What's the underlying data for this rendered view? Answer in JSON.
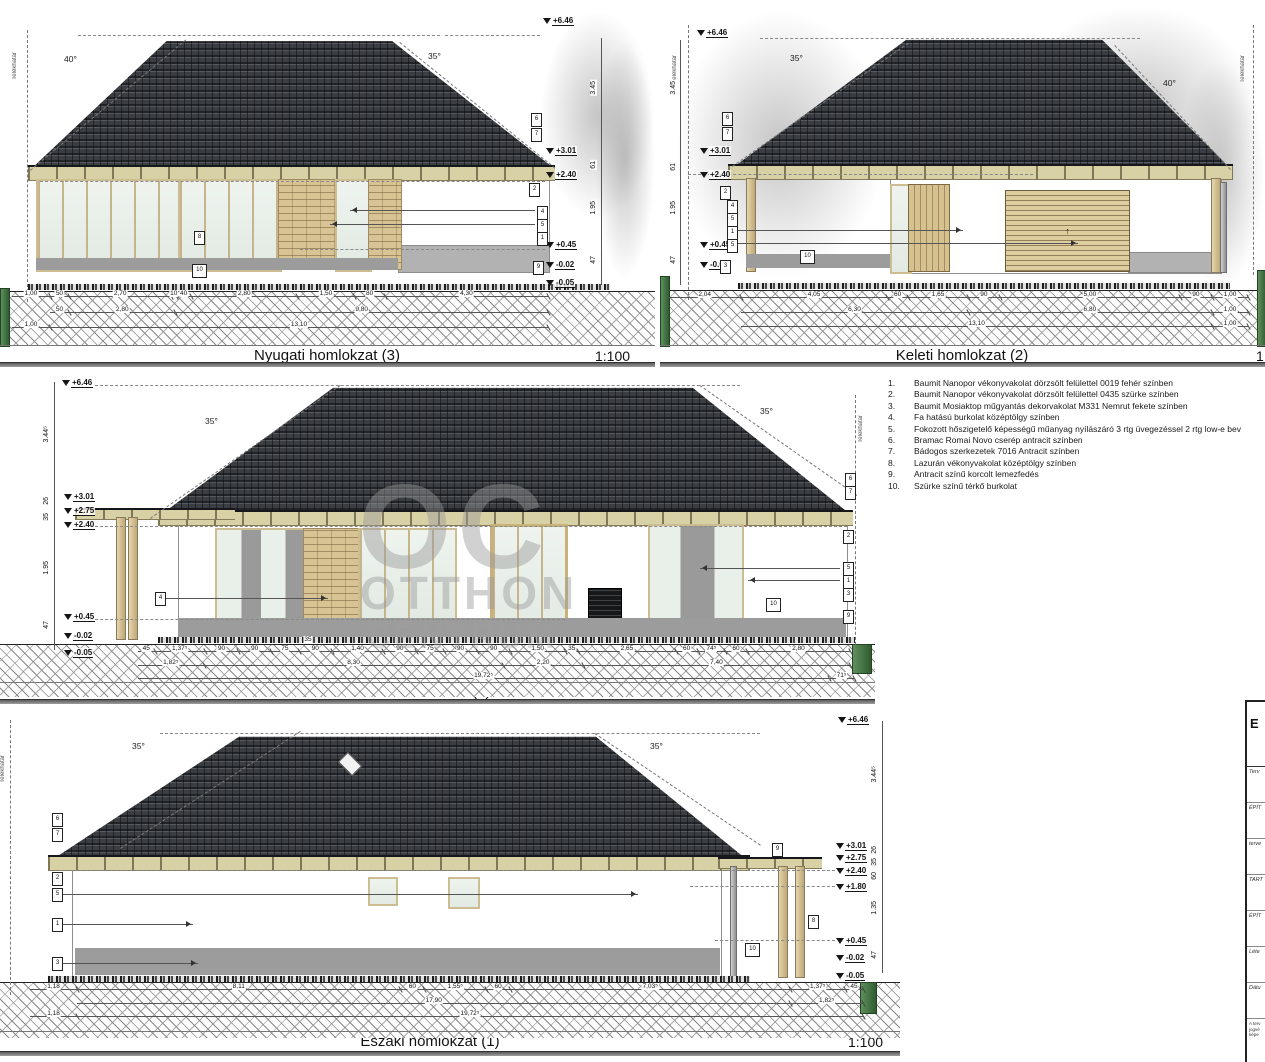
{
  "watermark": {
    "top": "OC",
    "mid": "OTTHON",
    "bottom": "CENTRUM"
  },
  "legend": {
    "items": [
      {
        "num": "1.",
        "text": "Baumit Nanopor vékonyvakolat dörzsölt felülettel 0019 fehér színben"
      },
      {
        "num": "2.",
        "text": "Baumit Nanopor vékonyvakolat dörzsölt felülettel 0435 szürke színben"
      },
      {
        "num": "3.",
        "text": "Baumit Mosiaktop műgyantás dekorvakolat M331 Nemrut fekete színben"
      },
      {
        "num": "4.",
        "text": "Fa hatású burkolat középtölgy színben"
      },
      {
        "num": "5.",
        "text": "Fokozott hőszigetelő képességű műanyag nyílászáró 3 rtg üvegezéssel 2 rtg low-e bev"
      },
      {
        "num": "6.",
        "text": "Bramac Romai Novo cserép antracit színben"
      },
      {
        "num": "7.",
        "text": "Bádogos szerkezetek 7016 Antracit színben"
      },
      {
        "num": "8.",
        "text": "Lazurán vékonyvakolat középtölgy színben"
      },
      {
        "num": "9.",
        "text": "Antracit színű korcolt lemezfedés"
      },
      {
        "num": "10.",
        "text": "Szürke színű térkő burkolat"
      }
    ]
  },
  "panels": {
    "west": {
      "title": "Nyugati homlokzat (3)",
      "scale": "1:100",
      "boundary": "Telekhatár",
      "angle_left": "40°",
      "angle_right": "35°",
      "levels": {
        "p646": "+6.46",
        "p301": "+3.01",
        "p240": "+2.40",
        "p045": "+0.45",
        "m002": "-0.02",
        "m005": "-0.05"
      },
      "vdims": {
        "d1": "3.45",
        "d2": "61",
        "d3": "1.95",
        "d4": "47"
      },
      "callouts": {
        "c1": "1",
        "c2": "2",
        "c4": "4",
        "c5": "5",
        "c6": "6",
        "c7": "7",
        "c8": "8",
        "c9": "9",
        "c10": "10"
      },
      "dims1": [
        "1,00",
        "50",
        "2,70",
        "10",
        "40",
        "2,80",
        "1,50",
        "80",
        "4,30"
      ],
      "dims2": [
        "_1,00",
        "50",
        "2,80",
        "9,80"
      ],
      "dims3": [
        "1,00",
        "13,10"
      ]
    },
    "east": {
      "title": "Keleti homlokzat (2)",
      "scale": "1:100",
      "boundary": "Telekhatár",
      "angle_left": "35°",
      "angle_right": "40°",
      "levels": {
        "p646": "+6.46",
        "p301": "+3.01",
        "p240": "+2.40",
        "p045": "+0.45",
        "m002": "-0.02"
      },
      "vdims": {
        "d1": "3.45",
        "d2": "61",
        "d3": "1.95",
        "d4": "47"
      },
      "callouts": {
        "c1": "1",
        "c2": "2",
        "c3": "3",
        "c4": "4",
        "c5": "5",
        "c6": "6",
        "c7": "7",
        "c10": "10"
      },
      "garage_arrow": "↑",
      "dims1": [
        "2,04",
        "4,05",
        "60",
        "1,65",
        "90",
        "5,00",
        "90",
        "1,00"
      ],
      "dims2": [
        "_2,04",
        "6,30",
        "6,80",
        "1,00"
      ],
      "dims3": [
        "_2,04",
        "13,10",
        "1,00"
      ]
    },
    "south": {
      "title": "Déli homlokzat (2)",
      "scale": "1:100",
      "boundary": "Telekhatár",
      "angle_left": "35°",
      "angle_right": "35°",
      "levels": {
        "p646": "+6.46",
        "p301": "+3.01",
        "p275": "+2.75",
        "p240": "+2.40",
        "p045": "+0.45",
        "m002": "-0.02",
        "m005": "-0.05"
      },
      "vdims": {
        "d1": "3.44⁵",
        "d2": "26",
        "d3": "35",
        "d4": "1.95",
        "d5": "47",
        "d6": "3"
      },
      "wall35": "35",
      "callouts": {
        "c1": "1",
        "c2": "2",
        "c3": "3",
        "c4": "4",
        "c5": "5",
        "c6": "6",
        "c7": "7",
        "c9": "9",
        "c10": "10"
      },
      "dims1": [
        "45",
        "1,37⁵",
        "90",
        "90",
        "75",
        "90",
        "1,40",
        "90",
        "75",
        "90",
        "90",
        "1,50",
        "35",
        "2,65",
        "60",
        "74⁵",
        "60",
        "2,80"
      ],
      "dims2": [
        "1,82⁵",
        "8,30",
        "2,20",
        "7,40"
      ],
      "dims3": [
        "19,72⁵",
        "71⁵"
      ]
    },
    "north": {
      "title": "Északi homlokzat (1)",
      "scale": "1:100",
      "boundary": "Telekhatár",
      "angle_left": "35°",
      "angle_right": "35°",
      "levels": {
        "p646": "+6.46",
        "p301": "+3.01",
        "p275": "+2.75",
        "p240": "+2.40",
        "p180": "+1.80",
        "p045": "+0.45",
        "m002": "-0.02",
        "m005": "-0.05"
      },
      "vdims": {
        "d1": "3.44⁵",
        "d2": "26",
        "d3": "35",
        "d4": "60",
        "d5": "1.35",
        "d6": "47"
      },
      "callouts": {
        "c1": "1",
        "c2": "2",
        "c3": "3",
        "c5": "5",
        "c6": "6",
        "c7": "7",
        "c8": "8",
        "c9": "9",
        "c10": "10"
      },
      "dims1": [
        "1,18",
        "8,11",
        "60",
        "1,55⁵",
        "60",
        "7,03⁵",
        "1,37⁵",
        "45"
      ],
      "dims2": [
        "_1,18",
        "17,90",
        "1,82⁵"
      ],
      "dims3": [
        "1,18",
        "19,72⁵"
      ]
    }
  },
  "titleblock": {
    "header": "E",
    "rows": [
      {
        "label": "Terv"
      },
      {
        "label": "ÉPÍT"
      },
      {
        "label": "terve"
      },
      {
        "label": "TART"
      },
      {
        "label": "ÉPÍT"
      },
      {
        "label": "Léte"
      },
      {
        "label": "Dátu"
      }
    ],
    "fine": "A terv jogvé képe"
  }
}
